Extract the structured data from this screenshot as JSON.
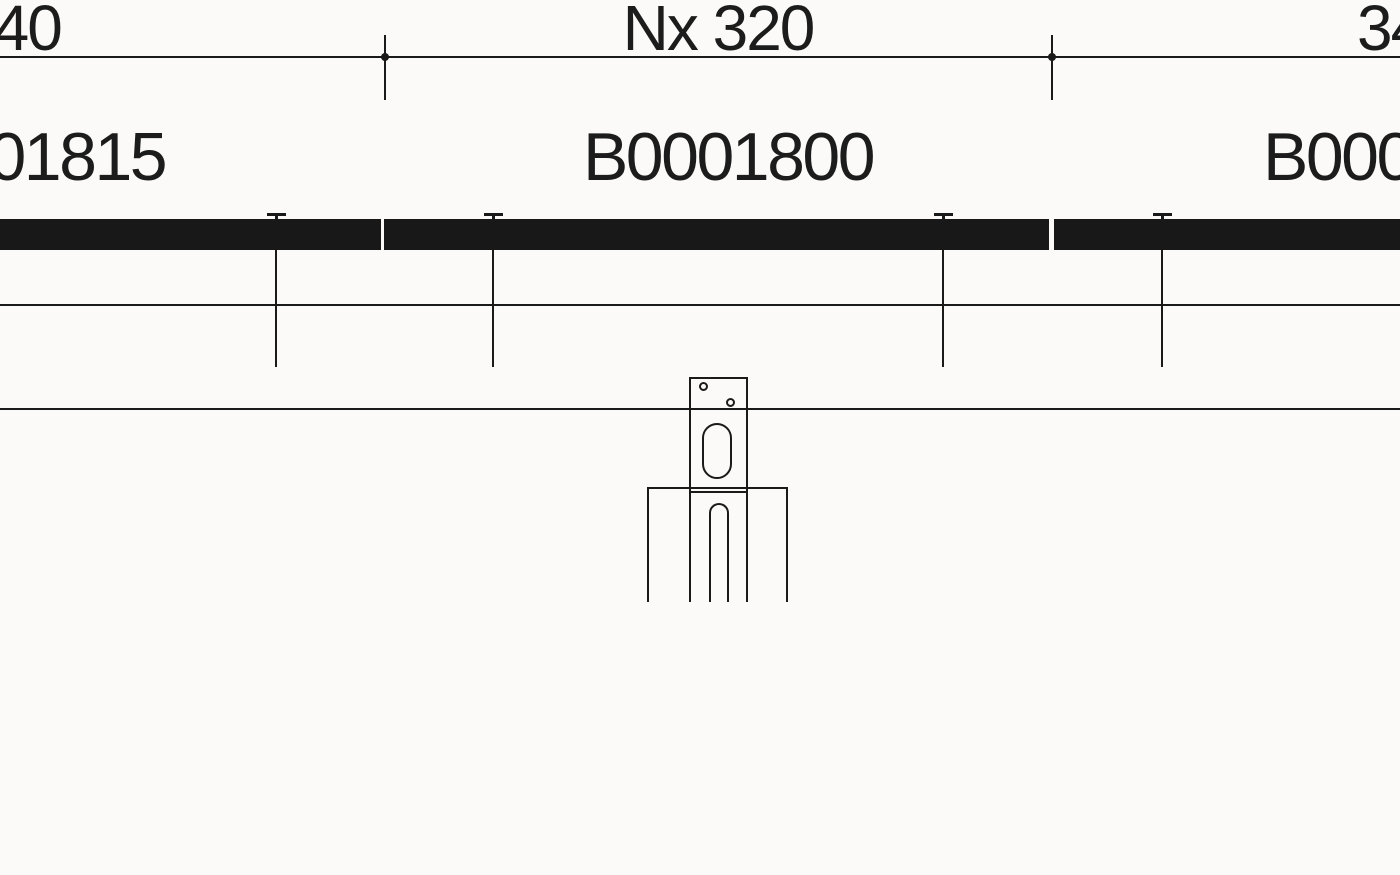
{
  "drawing": {
    "dimension_labels": {
      "left": "340",
      "center": "Nx 320",
      "right": "340"
    },
    "part_labels": {
      "left": "B0001815",
      "center": "B0001800",
      "right": "B0001815"
    },
    "colors": {
      "ink": "#1a1a1a",
      "rail_fill": "#181818",
      "background": "#fbfaf8"
    }
  }
}
